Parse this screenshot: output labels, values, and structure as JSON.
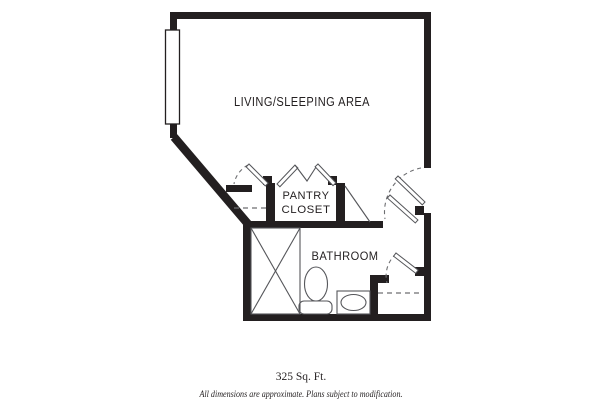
{
  "page": {
    "type": "apartment-floor-plan",
    "background": "#ffffff"
  },
  "plan": {
    "rooms": {
      "living_area": "LIVING/SLEEPING AREA",
      "pantry_line1": "PANTRY",
      "pantry_line2": "CLOSET",
      "bathroom": "BATHROOM"
    },
    "fixtures": {
      "window": "window-symbol",
      "shower": "shower-x-symbol",
      "toilet": "toilet-symbol",
      "sink": "sink-basin-symbol",
      "entry_door": "door-swing-symbol",
      "bathroom_door": "door-swing-symbol",
      "closet_door": "door-swing-symbol",
      "pantry_doors": "bifold-door-symbol",
      "closet_shelf": "dashed-shelf-line",
      "entry_closet_shelf": "dashed-shelf-line"
    },
    "colors": {
      "wall": "#231f20",
      "line": "#55565a",
      "background": "#ffffff"
    }
  },
  "footer": {
    "area": "325 Sq. Ft.",
    "disclaimer": "All dimensions are approximate. Plans subject to modification."
  }
}
